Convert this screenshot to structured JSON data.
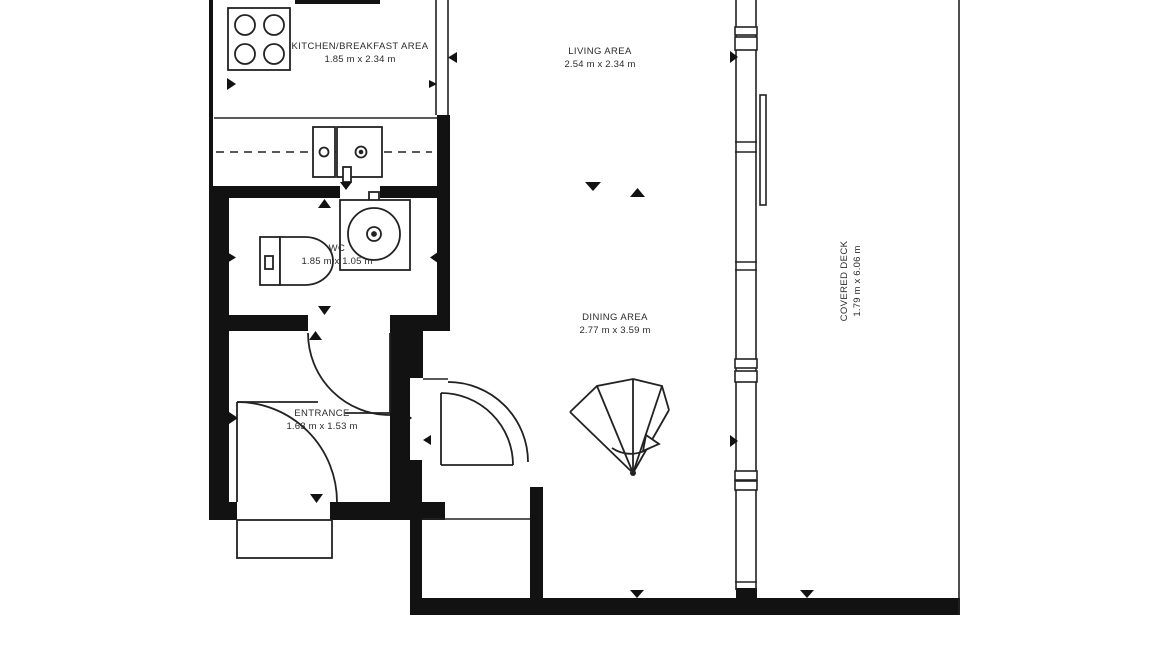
{
  "plan_title": "studio apartment floor plan",
  "rooms": {
    "kitchen": {
      "name": "KITCHEN/BREAKFAST AREA",
      "dims": "1.85 m x 2.34 m"
    },
    "living": {
      "name": "LIVING AREA",
      "dims": "2.54 m x 2.34 m"
    },
    "wc": {
      "name": "WC",
      "dims": "1.85 m x 1.05 m"
    },
    "dining": {
      "name": "DINING AREA",
      "dims": "2.77 m x 3.59 m"
    },
    "entrance": {
      "name": "ENTRANCE",
      "dims": "1.63 m x 1.53 m"
    },
    "deck": {
      "name": "COVERED DECK",
      "dims": "1.79 m x 6.06 m"
    }
  },
  "fixtures": [
    "stove-cooktop",
    "kitchen-sink-counter",
    "wc-toilet",
    "wc-basin",
    "winder-staircase",
    "entry-door-swing",
    "hall-door-swing",
    "vestibule-door-swings",
    "sliding-window-wall",
    "dimension-markers"
  ],
  "colors": {
    "wall": "#121212",
    "line": "#222222",
    "background": "#ffffff",
    "text": "#2b2b2b"
  }
}
